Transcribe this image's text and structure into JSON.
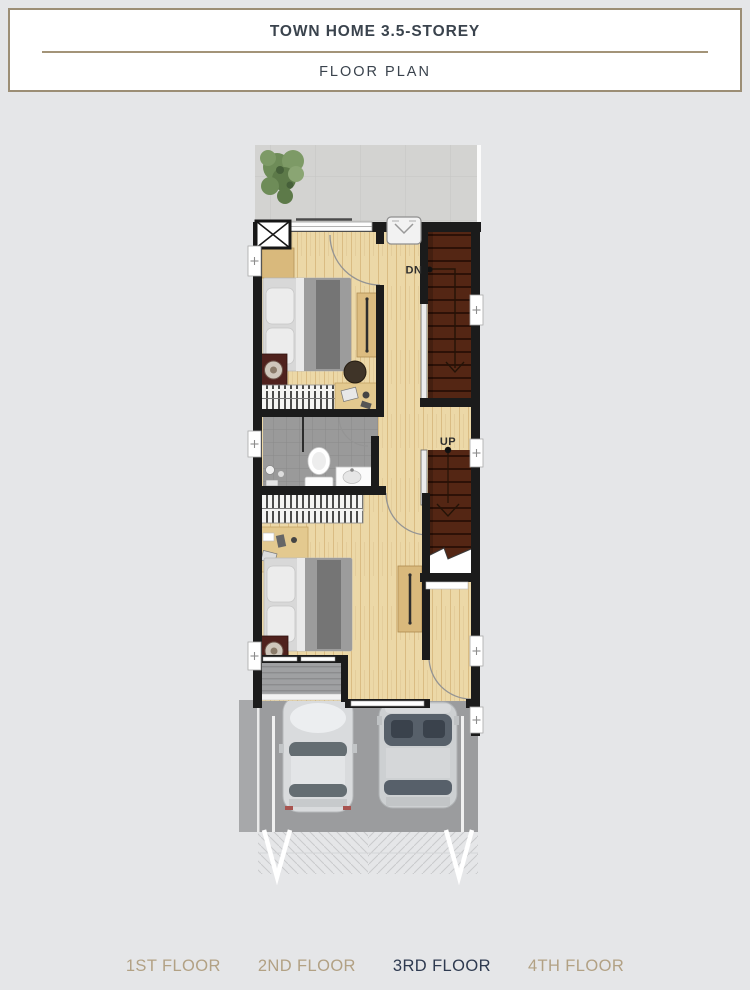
{
  "header": {
    "title": "TOWN HOME 3.5-STOREY",
    "subtitle": "FLOOR PLAN"
  },
  "plan": {
    "labels": {
      "stairs_down": "DN",
      "stairs_up": "UP"
    }
  },
  "floor_tabs": [
    {
      "label": "1ST FLOOR",
      "active": false
    },
    {
      "label": "2ND FLOOR",
      "active": false
    },
    {
      "label": "3RD FLOOR",
      "active": true
    },
    {
      "label": "4TH FLOOR",
      "active": false
    }
  ],
  "colors": {
    "page_background": "#e5e6e8",
    "header_border": "#9c8e75",
    "header_text": "#3a434d",
    "tab_inactive": "#b2a184",
    "tab_active": "#2e3a50",
    "wall": "#1b1b1b",
    "wood_floor": "#ecd8a7",
    "stair_brown": "#542614",
    "bathroom_tile": "#9a9a9a",
    "terrace_tile": "#d3d3d1",
    "garage_slab": "#9b9c9e",
    "tree_green": "#6e8c58"
  }
}
